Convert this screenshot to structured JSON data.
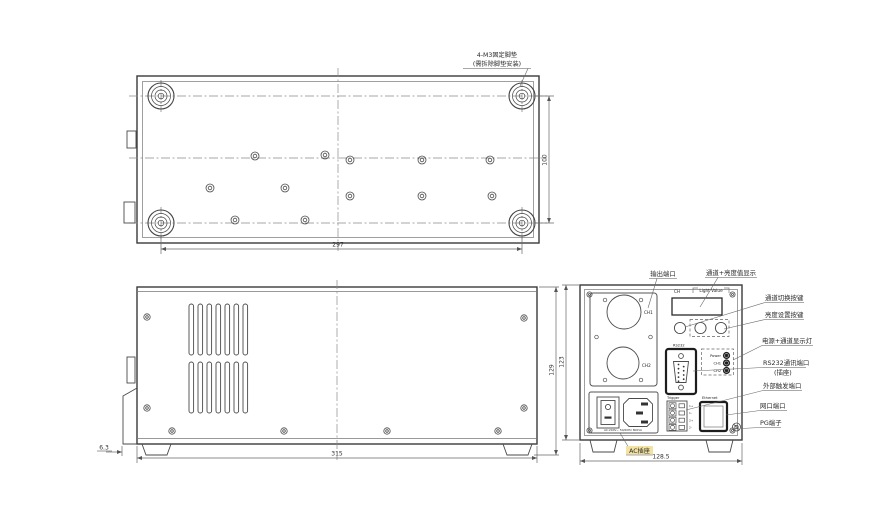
{
  "views": {
    "top": {
      "note_line1": "4-M3固定脚垫",
      "note_line2": "(需拆除脚垫安装)",
      "dim_width": "297",
      "dim_height": "100"
    },
    "side": {
      "dim_width": "315",
      "dim_flange": "6.3",
      "dim_height": "129"
    },
    "rear": {
      "dim_width": "128.5",
      "dim_height": "123",
      "callouts": {
        "output_port": "输出端口",
        "display": "通道+亮度值显示",
        "channel_switch": "通道切换按键",
        "brightness_set": "亮度设置按键",
        "power_leds": "电源+通道显示灯",
        "rs232_line1": "RS232通讯端口",
        "rs232_line2": "(插座)",
        "trigger": "外部触发端口",
        "ethernet": "网口端口",
        "pg": "PG端子",
        "ac_socket": "AC插座"
      },
      "panel": {
        "ch1": "CH1",
        "ch2": "CH2",
        "display_ch": "CH",
        "display_value": "Light Value",
        "rs232": "RS232",
        "led_power": "Power",
        "led_ch1": "CH1",
        "led_ch2": "CH2",
        "trigger": "Trigger",
        "ethernet": "Ethernet",
        "trigger_pins": [
          "1+",
          "1-",
          "2+",
          "2-"
        ],
        "ac_rating": "AC:240V~ 50/60Hz 800VA"
      }
    }
  }
}
